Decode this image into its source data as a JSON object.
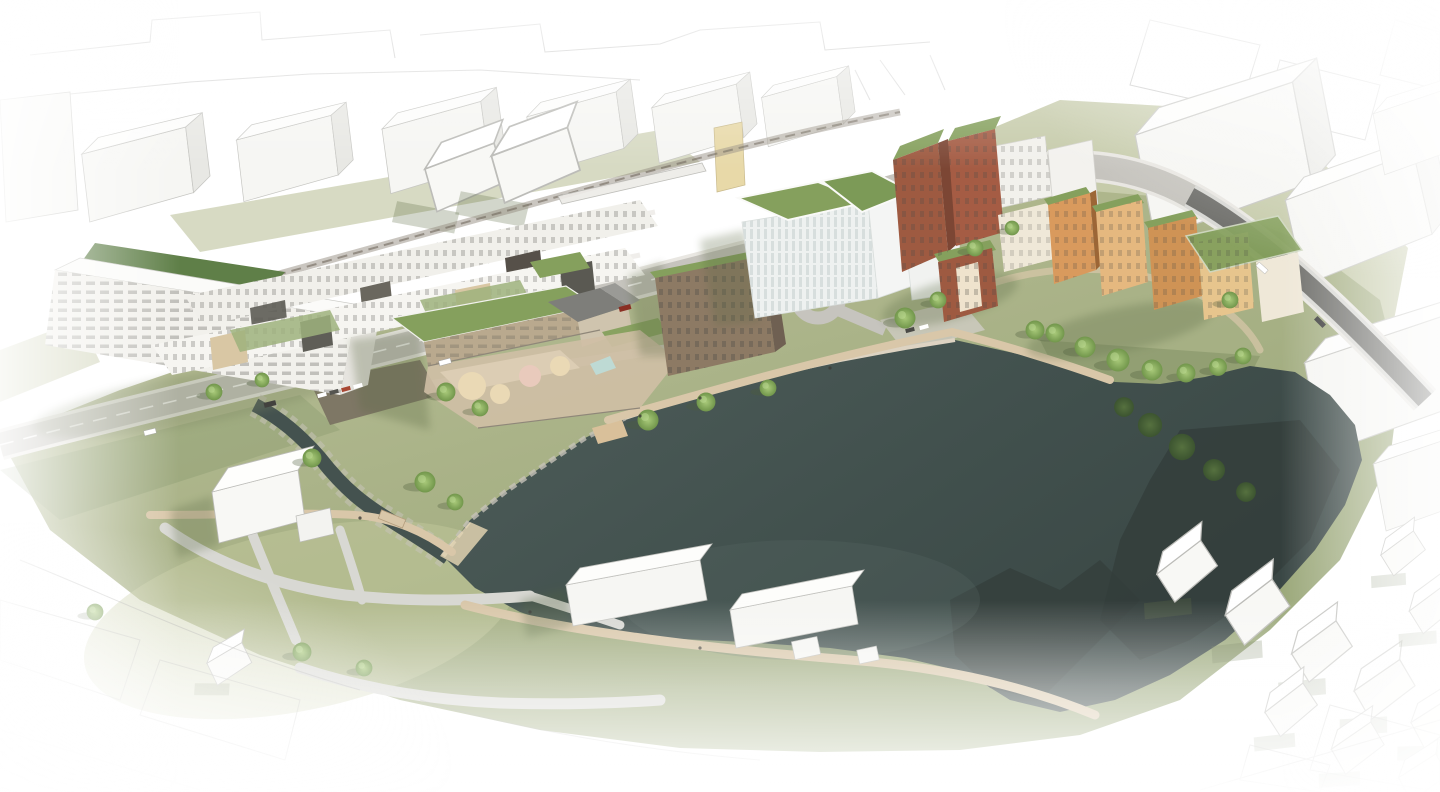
{
  "scene": {
    "kind": "architectural-aerial-rendering",
    "subject": "lakeside-masterplan-visualization",
    "features": [
      "sketched-context-outlines",
      "white-context-massing",
      "apartment-block-rows",
      "school-with-playground",
      "glass-office-with-green-roofs",
      "brick-housing-cluster",
      "timber-housing-cluster",
      "lake",
      "creek-with-rocky-banks",
      "main-road",
      "railway-corridor",
      "roundabout",
      "lakeside-promenade",
      "park-paths",
      "tree-groups",
      "white-context-houses"
    ]
  },
  "palette": {
    "bg": "#ffffff",
    "sketch_line": "#9a9a98",
    "massing_fill": "#f6f6f3",
    "massing_side": "#e8e8e4",
    "massing_line": "#c6c6c2",
    "grass": "#a9b287",
    "grass_light": "#bcc29b",
    "grass_dark": "#8a9a6d",
    "water": "#44524f",
    "water_shadow": "#333d3b",
    "rock": "#c6c2b8",
    "road": "#c6c4be",
    "road_dark": "#6e6e6a",
    "rail": "#958d81",
    "path_gray": "#d8d8d3",
    "path_tan": "#d9c7a9",
    "roof_green": "#85a05d",
    "roof_green_dark": "#5f7f48",
    "facade_white": "#f2f1ec",
    "facade_dark": "#5d5c55",
    "facade_tan": "#d9c7a4",
    "facade_brown": "#8d7a64",
    "facade_brick": "#9e5a41",
    "facade_orange": "#cf9355",
    "facade_cream": "#efe8d8",
    "tree": "#7aa24f",
    "tree_dark": "#4a6338",
    "sand": "#ead9b5",
    "play_pink": "#e9cabc",
    "pond": "#bedad4"
  }
}
